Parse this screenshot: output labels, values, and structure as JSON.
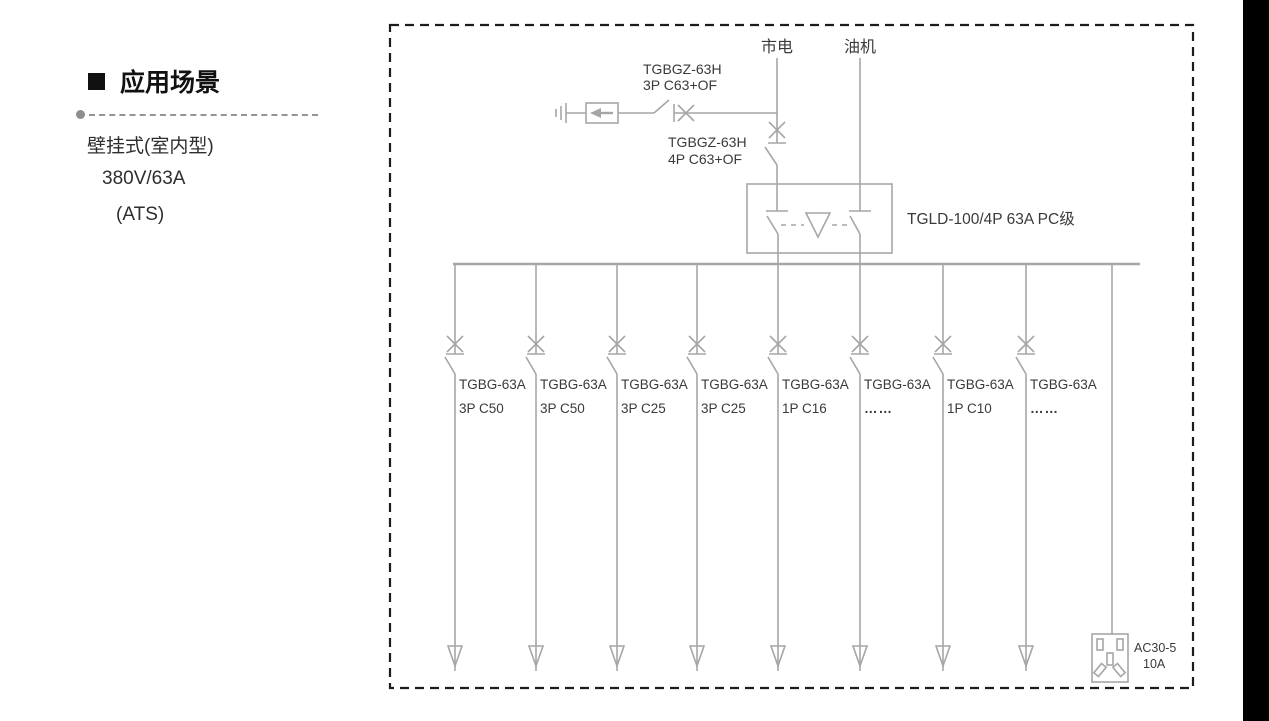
{
  "panel": {
    "title": "应用场景",
    "lines": [
      "壁挂式(室内型)",
      "380V/63A",
      "(ATS)"
    ]
  },
  "diagram": {
    "source_main": "市电",
    "source_gen": "油机",
    "spd_breaker": {
      "model": "TGBGZ-63H",
      "spec": "3P C63+OF"
    },
    "main_breaker": {
      "model": "TGBGZ-63H",
      "spec": "4P C63+OF"
    },
    "ats": {
      "label": "TGLD-100/4P 63A PC级"
    },
    "branches": [
      {
        "model": "TGBG-63A",
        "spec": "3P C50"
      },
      {
        "model": "TGBG-63A",
        "spec": "3P C50"
      },
      {
        "model": "TGBG-63A",
        "spec": "3P C25"
      },
      {
        "model": "TGBG-63A",
        "spec": "3P C25"
      },
      {
        "model": "TGBG-63A",
        "spec": "1P C16"
      },
      {
        "model": "TGBG-63A",
        "spec": "……"
      },
      {
        "model": "TGBG-63A",
        "spec": "1P C10"
      },
      {
        "model": "TGBG-63A",
        "spec": "……"
      }
    ],
    "socket": {
      "model": "AC30-5",
      "rating": "10A"
    }
  },
  "colors": {
    "line": "#a6a6a6",
    "text": "#3a3a3a",
    "frame": "#1c1c1c"
  }
}
